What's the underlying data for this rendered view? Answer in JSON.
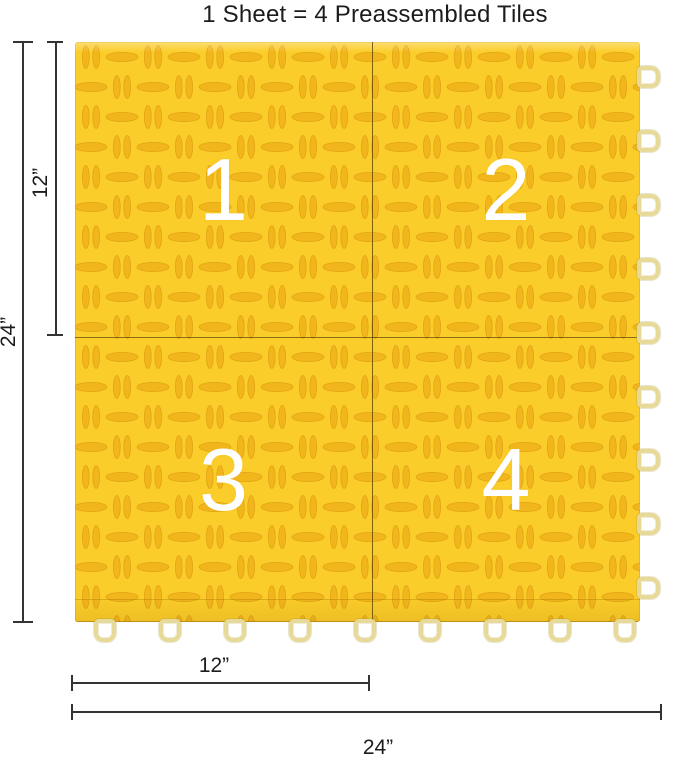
{
  "title": "1 Sheet = 4 Preassembled Tiles",
  "tiles": [
    {
      "number": "1"
    },
    {
      "number": "2"
    },
    {
      "number": "3"
    },
    {
      "number": "4"
    }
  ],
  "dimensions": {
    "left_full_height": "24”",
    "left_half_height": "12”",
    "bottom_half_width": "12”",
    "bottom_full_width": "24”"
  },
  "connectors": {
    "bottom_loop_count": 9,
    "right_loop_count": 9
  },
  "colors": {
    "tile_base": "#FBCD2A",
    "tile_mark_fill": "#F2B41C",
    "tile_mark_stroke": "#DFA013",
    "loop_border": "#E7DA99",
    "seam_line": "#584208",
    "dimension_line": "#333333",
    "number_text": "#FFFFFF",
    "title_text": "#1C1C1C"
  }
}
